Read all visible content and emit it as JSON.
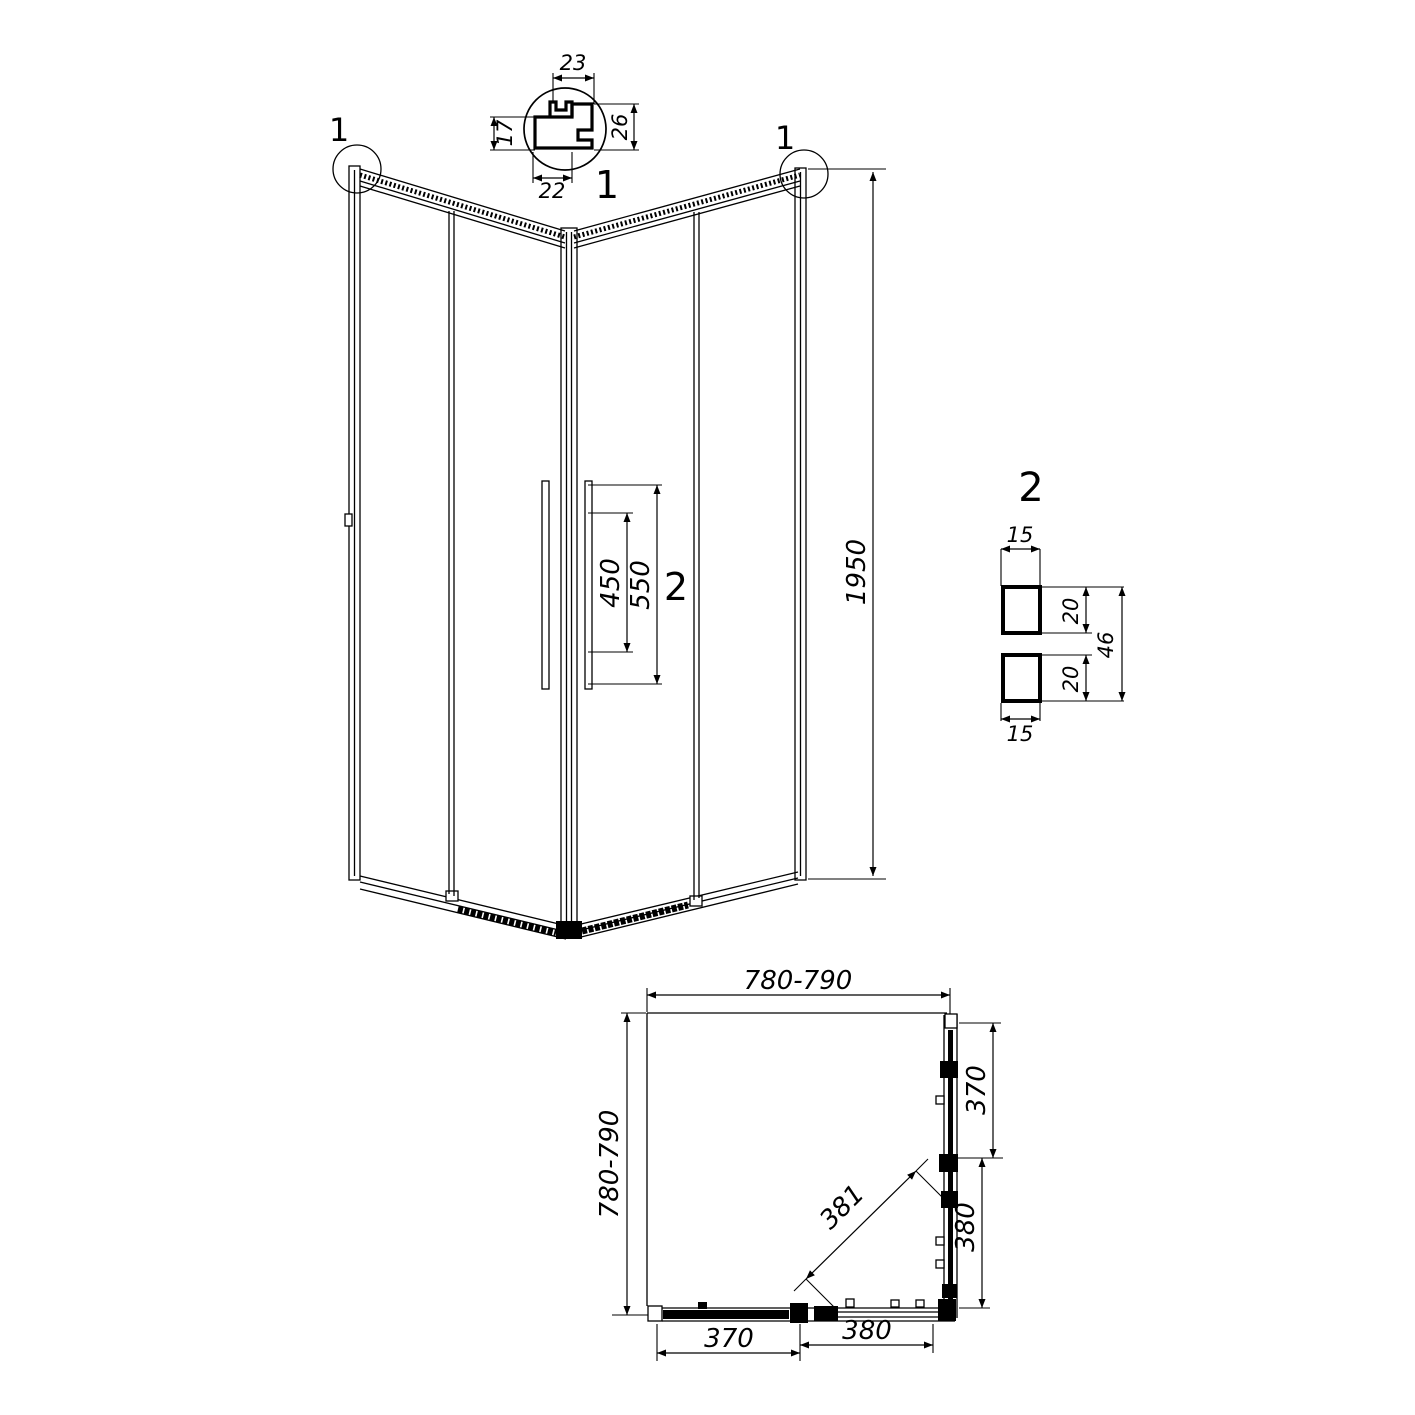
{
  "drawing": {
    "callouts": {
      "top_left": "1",
      "top_right": "1",
      "detail1_label": "1",
      "handle_detail_label": "2",
      "detail2_label": "2"
    },
    "detail1_dims": {
      "top": "23",
      "right": "26",
      "left": "17",
      "bottom": "22"
    },
    "elevation_dims": {
      "height": "1950",
      "handle_inner": "450",
      "handle_outer": "550"
    },
    "detail2_dims": {
      "top_width": "15",
      "top_height": "20",
      "bottom_height": "20",
      "overall": "46",
      "bottom_width": "15"
    },
    "plan_dims": {
      "width_top": "780-790",
      "depth_left": "780-790",
      "right_fixed": "370",
      "right_door": "380",
      "diagonal": "381",
      "bottom_fixed": "370",
      "bottom_door": "380"
    }
  }
}
